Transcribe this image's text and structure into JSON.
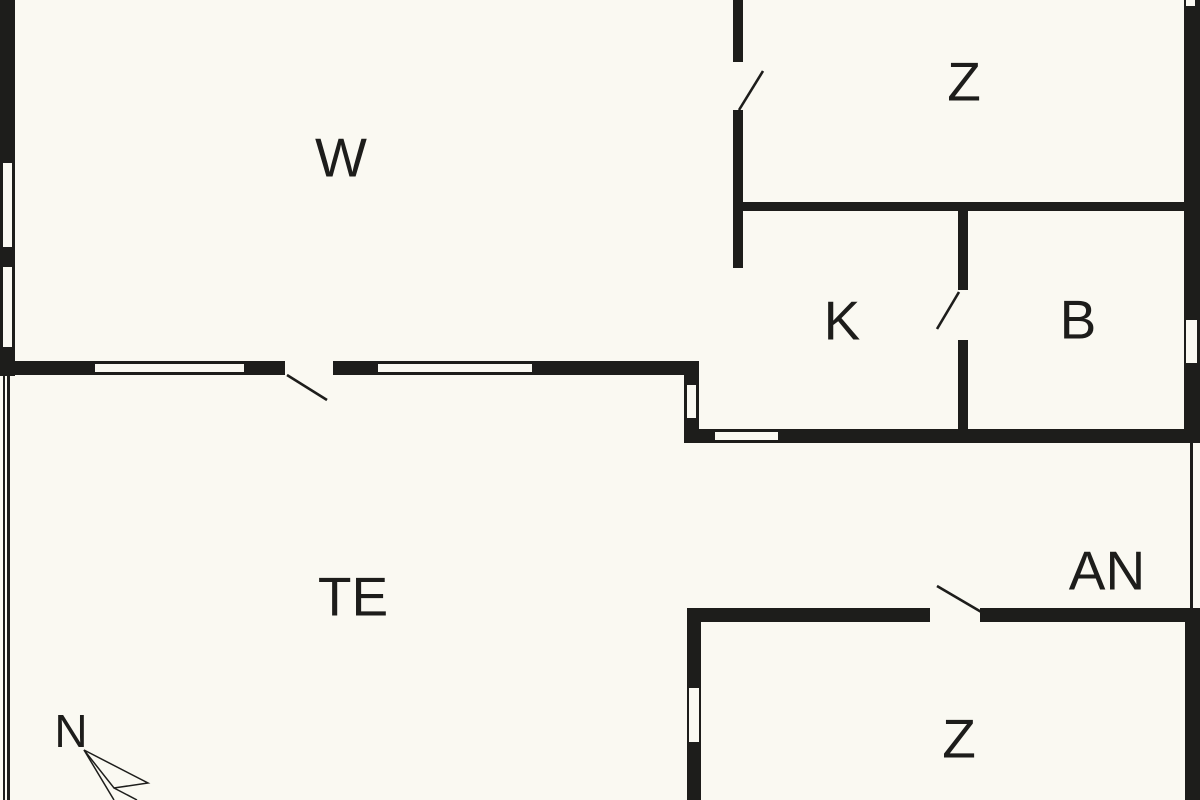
{
  "colors": {
    "background": "#faf9f2",
    "wall": "#1d1d1b",
    "text": "#1d1d1b"
  },
  "floorplan": {
    "rooms": [
      {
        "id": "room-w",
        "label": "W",
        "x": 341,
        "y": 158
      },
      {
        "id": "room-z-top",
        "label": "Z",
        "x": 964,
        "y": 82
      },
      {
        "id": "room-k",
        "label": "K",
        "x": 842,
        "y": 321
      },
      {
        "id": "room-b",
        "label": "B",
        "x": 1078,
        "y": 320
      },
      {
        "id": "room-te",
        "label": "TE",
        "x": 353,
        "y": 597
      },
      {
        "id": "room-an",
        "label": "AN",
        "x": 1107,
        "y": 571
      },
      {
        "id": "room-z-bottom",
        "label": "Z",
        "x": 959,
        "y": 739
      }
    ],
    "compass": {
      "label": "N",
      "x": 71,
      "y": 731,
      "arrow_polygon": "84,750 148,783 114,788",
      "arrow_lines": [
        {
          "x1": 84,
          "y1": 750,
          "x2": 114,
          "y2": 800
        },
        {
          "x1": 114,
          "y1": 788,
          "x2": 137,
          "y2": 800
        }
      ]
    },
    "walls": [
      {
        "x": 0,
        "y": 0,
        "w": 15,
        "h": 376
      },
      {
        "x": 0,
        "y": 361,
        "w": 285,
        "h": 14
      },
      {
        "x": 333,
        "y": 361,
        "w": 366,
        "h": 14
      },
      {
        "x": 733,
        "y": 0,
        "w": 10,
        "h": 62
      },
      {
        "x": 733,
        "y": 110,
        "w": 10,
        "h": 158
      },
      {
        "x": 733,
        "y": 202,
        "w": 467,
        "h": 9
      },
      {
        "x": 958,
        "y": 211,
        "w": 10,
        "h": 79
      },
      {
        "x": 958,
        "y": 340,
        "w": 10,
        "h": 89
      },
      {
        "x": 1184,
        "y": 0,
        "w": 16,
        "h": 443
      },
      {
        "x": 684,
        "y": 375,
        "w": 15,
        "h": 54
      },
      {
        "x": 684,
        "y": 429,
        "w": 516,
        "h": 14
      },
      {
        "x": 687,
        "y": 608,
        "w": 243,
        "h": 14
      },
      {
        "x": 980,
        "y": 608,
        "w": 220,
        "h": 14
      },
      {
        "x": 687,
        "y": 608,
        "w": 14,
        "h": 192
      },
      {
        "x": 1185,
        "y": 608,
        "w": 15,
        "h": 192
      }
    ],
    "thin_lines": [
      {
        "x": 3,
        "y": 376,
        "w": 2,
        "h": 424
      },
      {
        "x": 7,
        "y": 376,
        "w": 3,
        "h": 424
      },
      {
        "x": 1190,
        "y": 443,
        "w": 3,
        "h": 165
      }
    ],
    "windows": [
      {
        "x": 3,
        "y": 163,
        "w": 9,
        "h": 84
      },
      {
        "x": 3,
        "y": 267,
        "w": 9,
        "h": 80
      },
      {
        "x": 95,
        "y": 364,
        "w": 149,
        "h": 8
      },
      {
        "x": 378,
        "y": 364,
        "w": 154,
        "h": 8
      },
      {
        "x": 687,
        "y": 385,
        "w": 9,
        "h": 33
      },
      {
        "x": 715,
        "y": 432,
        "w": 63,
        "h": 8
      },
      {
        "x": 1186,
        "y": 0,
        "w": 9,
        "h": 6
      },
      {
        "x": 1186,
        "y": 320,
        "w": 11,
        "h": 43
      },
      {
        "x": 689,
        "y": 688,
        "w": 10,
        "h": 54
      }
    ],
    "door_swings": [
      {
        "x1": 287,
        "y1": 375,
        "x2": 327,
        "y2": 400
      },
      {
        "x1": 739,
        "y1": 110,
        "x2": 763,
        "y2": 71
      },
      {
        "x1": 959,
        "y1": 292,
        "x2": 937,
        "y2": 329
      },
      {
        "x1": 937,
        "y1": 586,
        "x2": 983,
        "y2": 613
      }
    ]
  }
}
